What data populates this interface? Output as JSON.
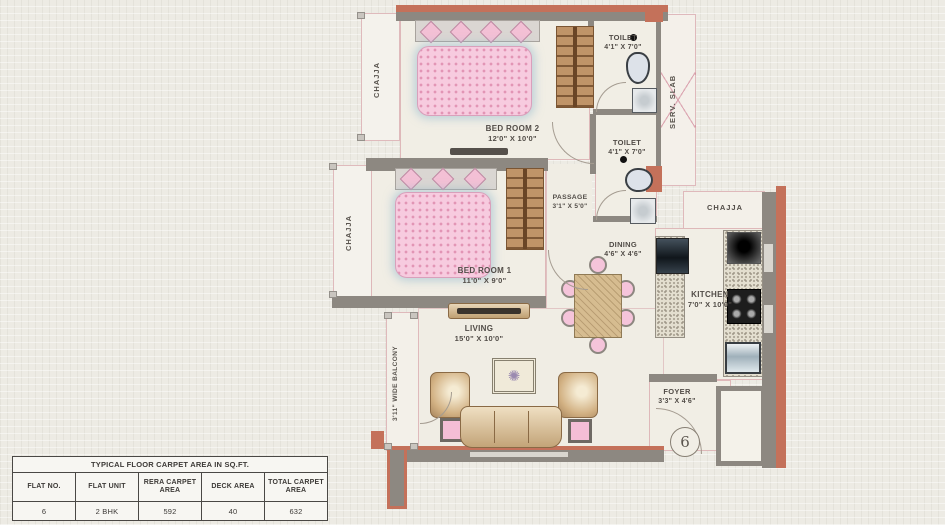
{
  "plan": {
    "rooms": {
      "bedroom2": {
        "name": "BED ROOM 2",
        "dims": "12'0\" X 10'0\""
      },
      "bedroom1": {
        "name": "BED ROOM 1",
        "dims": "11'0\" X 9'0\""
      },
      "toilet_top": {
        "name": "TOILET",
        "dims": "4'1\" X 7'0\""
      },
      "toilet_mid": {
        "name": "TOILET",
        "dims": "4'1\" X 7'0\""
      },
      "passage": {
        "name": "PASSAGE",
        "dims": "3'1\" X 5'0\""
      },
      "dining": {
        "name": "DINING",
        "dims": "4'6\" X 4'6\""
      },
      "kitchen": {
        "name": "KITCHEN",
        "dims": "7'0\" X 10'0\""
      },
      "living": {
        "name": "LIVING",
        "dims": "15'0\" X 10'0\""
      },
      "foyer": {
        "name": "FOYER",
        "dims": "3'3\" X 4'6\""
      }
    },
    "annotations": {
      "chajja_top_left": "CHAJJA",
      "chajja_mid_left": "CHAJJA",
      "chajja_right": "CHAJJA",
      "serv_slab": "SERV. SLAB",
      "balcony": "3'11\" WIDE BALCONY",
      "flat_marker": "6"
    }
  },
  "area_table": {
    "title": "TYPICAL FLOOR  CARPET AREA IN SQ.FT.",
    "headers": [
      "FLAT NO.",
      "FLAT UNIT",
      "RERA CARPET AREA",
      "DECK AREA",
      "TOTAL CARPET AREA"
    ],
    "row": [
      "6",
      "2 BHK",
      "592",
      "40",
      "632"
    ]
  },
  "colors": {
    "wall_gray": "#8d8881",
    "accent_salmon": "#c4715a",
    "room_fill": "#f1eee5",
    "pink_furniture": "#f5c4da",
    "wood_tan": "#c09468",
    "page_bg": "#edebe4"
  }
}
